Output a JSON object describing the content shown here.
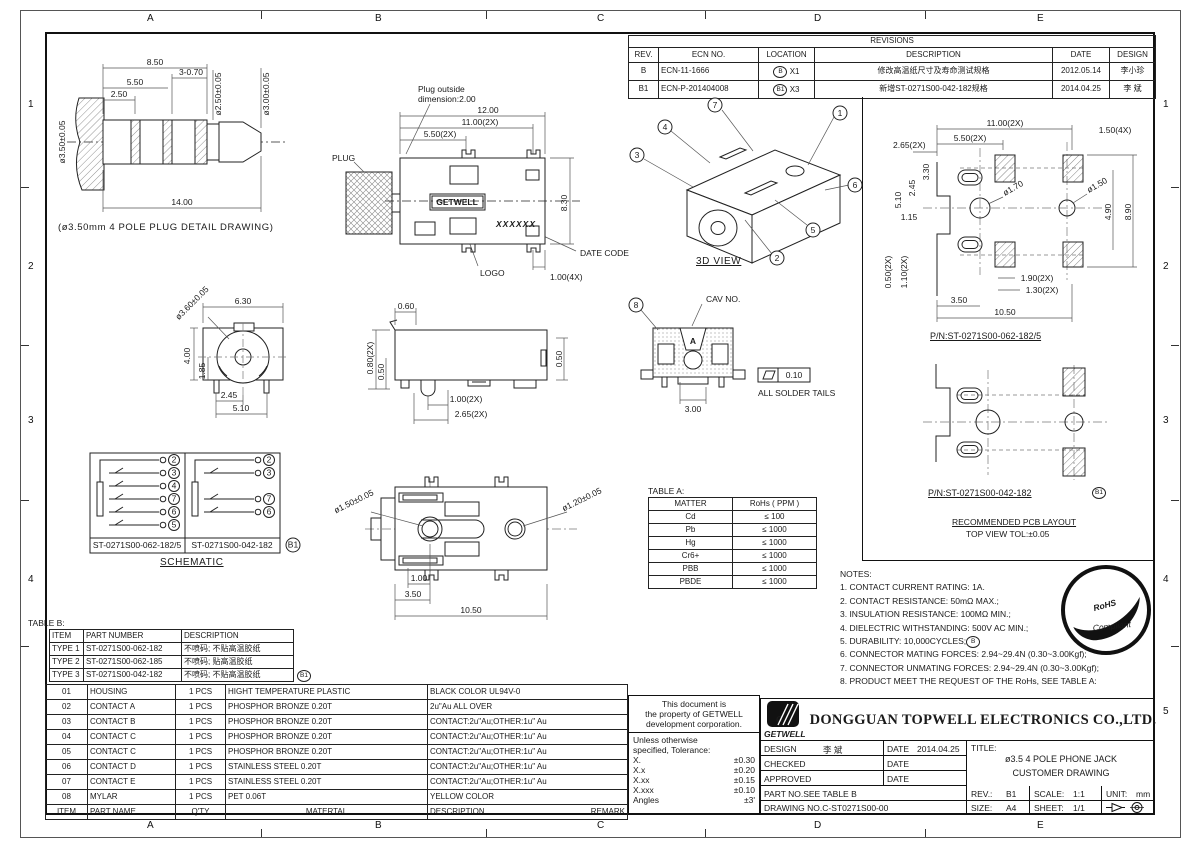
{
  "zones": {
    "cols": [
      "A",
      "B",
      "C",
      "D",
      "E"
    ],
    "rows": [
      "1",
      "2",
      "3",
      "4",
      "5"
    ]
  },
  "revisions": {
    "title": "REVISIONS",
    "headers": {
      "rev": "REV.",
      "ecn": "ECN NO.",
      "location": "LOCATION",
      "description": "DESCRIPTION",
      "date": "DATE",
      "design": "DESIGN"
    },
    "rows": [
      {
        "rev": "B",
        "ecn": "ECN-11-1666",
        "loc_letter": "B",
        "loc_qty": "X1",
        "description": "修改高温纸尺寸及寿命测试规格",
        "date": "2012.05.14",
        "design": "李小珍"
      },
      {
        "rev": "B1",
        "ecn": "ECN-P-201404008",
        "loc_letter": "B1",
        "loc_qty": "X3",
        "description": "新增ST-0271S00-042-182规格",
        "date": "2014.04.25",
        "design": "李 斌"
      }
    ]
  },
  "plug_detail": {
    "caption": "(ø3.50mm 4 POLE PLUG DETAIL DRAWING)",
    "d850": "8.50",
    "d3070": "3-0.70",
    "d550": "5.50",
    "d250": "2.50",
    "d1400": "14.00",
    "dia350": "ø3.50±0.05",
    "dia250": "ø2.50±0.05",
    "dia300": "ø3.00±0.05"
  },
  "top_view": {
    "note1": "Plug outside",
    "note2": "dimension:2.00",
    "d1200": "12.00",
    "d1100": "11.00(2X)",
    "d550": "5.50(2X)",
    "d830": "8.30",
    "d100": "1.00(4X)",
    "plug": "PLUG",
    "logo": "LOGO",
    "date_code": "DATE CODE",
    "brand": "GETWELL",
    "marking": "XXXXXX"
  },
  "view3d": {
    "caption": "3D VIEW",
    "balloons": [
      "1",
      "2",
      "3",
      "4",
      "5",
      "6",
      "7"
    ]
  },
  "pcb1": {
    "pn": "P/N:ST-0271S00-062-182/5",
    "d1100": "11.00(2X)",
    "d550": "5.50(2X)",
    "d150": "1.50(4X)",
    "d265": "2.65(2X)",
    "d330": "3.30",
    "d245": "2.45",
    "d510": "5.10",
    "d115": "1.15",
    "dia170": "ø1.70",
    "dia150": "ø1.50",
    "d490": "4.90",
    "d890": "8.90",
    "d050": "0.50(2X)",
    "d110": "1.10(2X)",
    "d190": "1.90(2X)",
    "d130": "1.30(2X)",
    "d350": "3.50",
    "d1050": "10.50"
  },
  "pcb2": {
    "pn": "P/N:ST-0271S00-042-182",
    "balloon": "B1",
    "cap1": "RECOMMENDED PCB LAYOUT",
    "cap2": "TOP VIEW TOL:±0.05"
  },
  "front_view": {
    "dia360": "ø3.60±0.05",
    "d630": "6.30",
    "d400": "4.00",
    "d185": "1.85",
    "d245": "2.45",
    "d510": "5.10"
  },
  "side_view": {
    "d060": "0.60",
    "d080": "0.80(2X)",
    "d050a": "0.50",
    "d050b": "0.50",
    "d100": "1.00(2X)",
    "d265": "2.65(2X)"
  },
  "rear_view": {
    "balloon": "8",
    "cav": "CAV NO.",
    "cav_letter": "A",
    "d300": "3.00",
    "flatness": "0.10",
    "note": "ALL SOLDER TAILS"
  },
  "schematic": {
    "caption": "SCHEMATIC",
    "left_pn": "ST-0271S00-062-182/5",
    "right_pn": "ST-0271S00-042-182",
    "balloon": "B1",
    "left_pins": [
      "2",
      "3",
      "4",
      "7",
      "6",
      "5"
    ],
    "right_pins": [
      "2",
      "3",
      "7",
      "6"
    ]
  },
  "bottom_view": {
    "dia150": "ø1.50±0.05",
    "dia120": "ø1.20±0.05",
    "d100": "1.00",
    "d350": "3.50",
    "d1050": "10.50"
  },
  "table_a": {
    "label": "TABLE A:",
    "h_matter": "MATTER",
    "h_rohs": "RoHs ( PPM )",
    "rows": [
      [
        "Cd",
        "≤ 100"
      ],
      [
        "Pb",
        "≤ 1000"
      ],
      [
        "Hg",
        "≤ 1000"
      ],
      [
        "Cr6+",
        "≤ 1000"
      ],
      [
        "PBB",
        "≤ 1000"
      ],
      [
        "PBDE",
        "≤ 1000"
      ]
    ]
  },
  "notes": {
    "title": "NOTES:",
    "items": [
      "1. CONTACT CURRENT RATING: 1A.",
      "2. CONTACT RESISTANCE: 50mΩ MAX.;",
      "3. INSULATION RESISTANCE: 100MΩ MIN.;",
      "4. DIELECTRIC WITHSTANDING: 500V AC MIN.;",
      "5. DURABILITY: 10,000CYCLES;",
      "6. CONNECTOR MATING FORCES: 2.94~29.4N (0.30~3.00Kgf);",
      "7. CONNECTOR UNMATING FORCES: 2.94~29.4N (0.30~3.00Kgf);",
      "8. PRODUCT MEET THE REQUEST OF THE RoHs, SEE TABLE A:"
    ],
    "note5_balloon": "B"
  },
  "rohs": {
    "line1": "RoHS",
    "line2": "Compliant"
  },
  "table_b": {
    "label": "TABLE B:",
    "th_item": "ITEM",
    "th_pn": "PART NUMBER",
    "th_desc": "DESCRIPTION",
    "types": [
      {
        "item": "TYPE 1",
        "pn": "ST-0271S00-062-182",
        "desc": "不喷码; 不贴高温胶纸"
      },
      {
        "item": "TYPE 2",
        "pn": "ST-0271S00-062-185",
        "desc": "不喷码; 贴高温胶纸"
      },
      {
        "item": "TYPE 3",
        "pn": "ST-0271S00-042-182",
        "desc": "不喷码; 不贴高温胶纸"
      }
    ],
    "type3_balloon": "B1",
    "parts": [
      {
        "item": "01",
        "name": "HOUSING",
        "qty": "1 PCS",
        "material": "HIGHT TEMPERATURE PLASTIC",
        "desc": "BLACK COLOR   UL94V-0"
      },
      {
        "item": "02",
        "name": "CONTACT A",
        "qty": "1 PCS",
        "material": "PHOSPHOR BRONZE 0.20T",
        "desc": "2u\"Au ALL OVER"
      },
      {
        "item": "03",
        "name": "CONTACT B",
        "qty": "1 PCS",
        "material": "PHOSPHOR BRONZE 0.20T",
        "desc": "CONTACT:2u\"Au;OTHER:1u\" Au"
      },
      {
        "item": "04",
        "name": "CONTACT C",
        "qty": "1 PCS",
        "material": "PHOSPHOR BRONZE 0.20T",
        "desc": "CONTACT:2u\"Au;OTHER:1u\" Au"
      },
      {
        "item": "05",
        "name": "CONTACT C",
        "qty": "1 PCS",
        "material": "PHOSPHOR BRONZE 0.20T",
        "desc": "CONTACT:2u\"Au;OTHER:1u\" Au"
      },
      {
        "item": "06",
        "name": "CONTACT D",
        "qty": "1 PCS",
        "material": "STAINLESS STEEL 0.20T",
        "desc": "CONTACT:2u\"Au;OTHER:1u\" Au"
      },
      {
        "item": "07",
        "name": "CONTACT E",
        "qty": "1 PCS",
        "material": "STAINLESS STEEL 0.20T",
        "desc": "CONTACT:2u\"Au;OTHER:1u\" Au"
      },
      {
        "item": "08",
        "name": "MYLAR",
        "qty": "1 PCS",
        "material": "PET 0.06T",
        "desc": "YELLOW COLOR"
      }
    ],
    "footer": {
      "item": "ITEM",
      "name": "PART NAME",
      "qty": "Q'TY",
      "material": "MATERTAL",
      "desc": "DESCRIPTION",
      "remark": "REMARK"
    }
  },
  "property_note": {
    "l1": "This document is",
    "l2": "the property of GETWELL",
    "l3": "development corporation."
  },
  "tolerance": {
    "l1": "Unless otherwise",
    "l2": "specified, Tolerance:",
    "rows": [
      [
        "X.",
        "±0.30"
      ],
      [
        "X.x",
        "±0.20"
      ],
      [
        "X.xx",
        "±0.15"
      ],
      [
        "X.xxx",
        "±0.10"
      ],
      [
        "Angles",
        "±3'"
      ]
    ]
  },
  "title_block": {
    "logo": "GETWELL",
    "company": "DONGGUAN TOPWELL ELECTRONICS CO.,LTD.",
    "design_label": "DESIGN",
    "design_value": "李 斌",
    "date_label": "DATE",
    "date_value": "2014.04.25",
    "checked_label": "CHECKED",
    "approved_label": "APPROVED",
    "title_label": "TITLE:",
    "title1": "ø3.5 4 POLE PHONE JACK",
    "title2": "CUSTOMER DRAWING",
    "part_no": "PART NO.SEE TABLE B",
    "drawing_no": "DRAWING NO.C-ST0271S00-00",
    "rev_label": "REV.:",
    "rev": "B1",
    "scale_label": "SCALE:",
    "scale": "1:1",
    "unit_label": "UNIT:",
    "unit": "mm",
    "size_label": "SIZE:",
    "size": "A4",
    "sheet_label": "SHEET:",
    "sheet": "1/1"
  }
}
